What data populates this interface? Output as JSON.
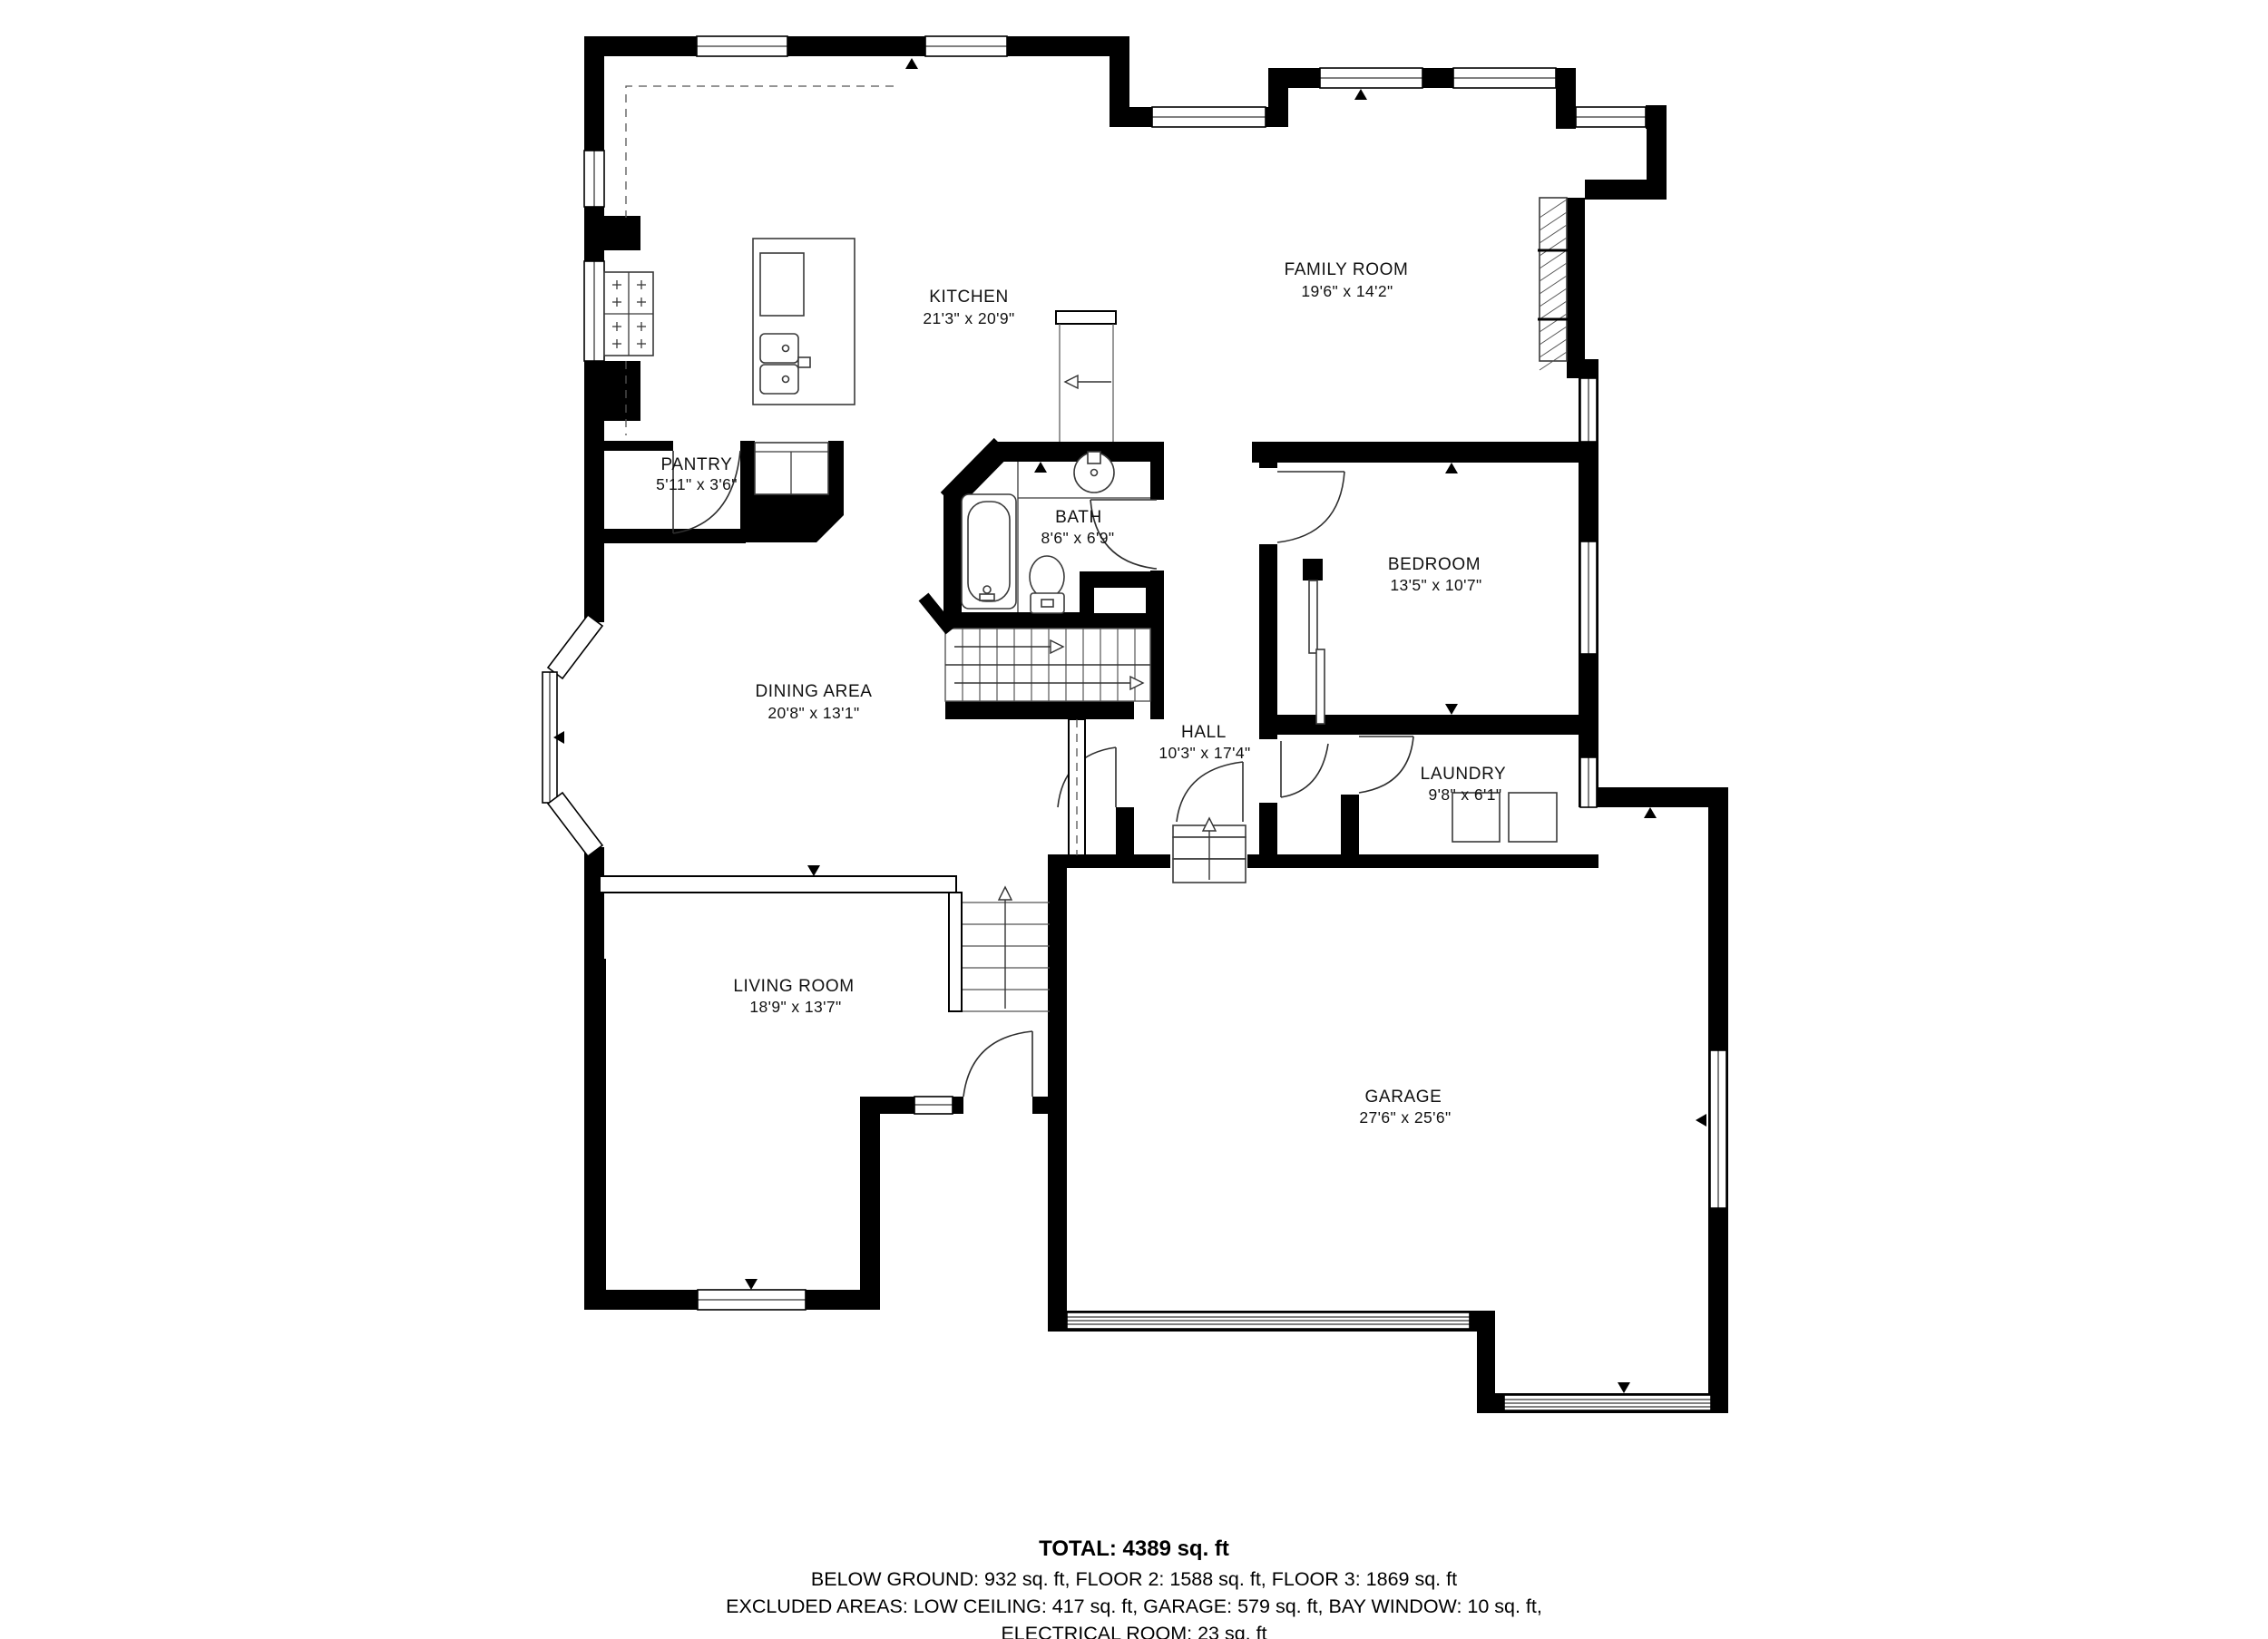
{
  "plan": {
    "rooms": [
      {
        "name": "KITCHEN",
        "dims": "21'3\" x 20'9\""
      },
      {
        "name": "FAMILY ROOM",
        "dims": "19'6\" x 14'2\""
      },
      {
        "name": "PANTRY",
        "dims": "5'11\" x 3'6\""
      },
      {
        "name": "BATH",
        "dims": "8'6\" x 6'9\""
      },
      {
        "name": "BEDROOM",
        "dims": "13'5\" x 10'7\""
      },
      {
        "name": "DINING AREA",
        "dims": "20'8\" x 13'1\""
      },
      {
        "name": "HALL",
        "dims": "10'3\" x 17'4\""
      },
      {
        "name": "LAUNDRY",
        "dims": "9'8\" x 6'1\""
      },
      {
        "name": "LIVING ROOM",
        "dims": "18'9\" x 13'7\""
      },
      {
        "name": "GARAGE",
        "dims": "27'6\" x 25'6\""
      }
    ]
  },
  "summary": {
    "total": "TOTAL: 4389 sq. ft",
    "line2": "BELOW GROUND: 932 sq. ft, FLOOR 2: 1588 sq. ft, FLOOR 3: 1869 sq. ft",
    "line3": "EXCLUDED AREAS: LOW CEILING: 417 sq. ft, GARAGE: 579 sq. ft, BAY WINDOW: 10 sq. ft,",
    "line4": "ELECTRICAL ROOM: 23 sq. ft"
  }
}
